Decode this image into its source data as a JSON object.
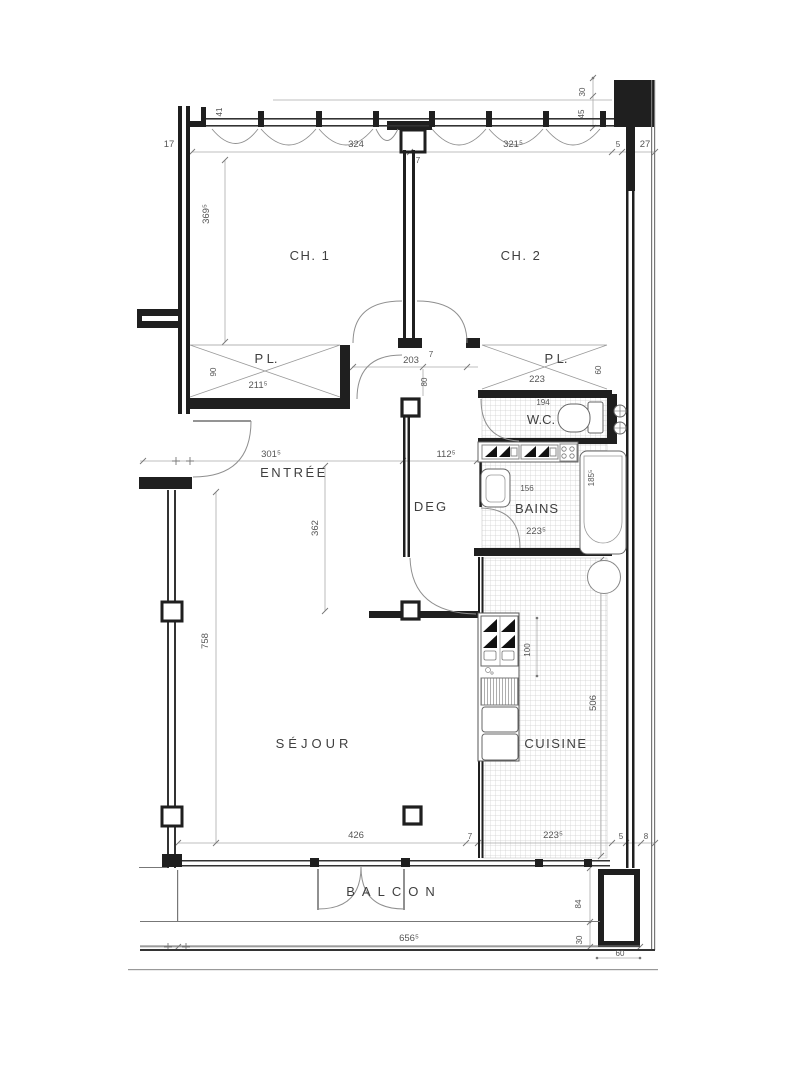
{
  "page": {
    "type": "apartment floor plan drawing",
    "background": "#ffffff"
  },
  "colors": {
    "wall": "#1f1f1f",
    "thin_line": "#777777",
    "dim_line": "#ababab",
    "dim_text": "#555555",
    "room_text": "#3f3f3f",
    "tile": "#cfcfcf",
    "fixture": "#666666"
  },
  "labels": {
    "ch1": "CH. 1",
    "ch2": "CH. 2",
    "pl_left": "P L.",
    "pl_right": "P L.",
    "wc": "W.C.",
    "bains": "BAINS",
    "entree": "ENTRÉE",
    "deg": "DEG",
    "sejour": "SÉJOUR",
    "cuisine": "CUISINE",
    "balcon": "BALCON"
  },
  "dimensions": {
    "top_window_left": "324",
    "top_window_right": "321⁵",
    "top_mullion": "7",
    "wall_17": "17",
    "sill_41": "41",
    "col_30": "30",
    "col_45": "45",
    "col_5": "5",
    "col_27": "27",
    "ch1_depth": "369⁵",
    "pl_left_width": "211⁵",
    "pl_left_depth": "90",
    "corridor_width": "203",
    "corridor_wall": "7",
    "corridor_gap": "80",
    "pl_right_width": "223",
    "pl_right_depth": "60",
    "wc_width": "194",
    "entree_width": "301⁵",
    "deg_width": "112⁵",
    "deg_length": "362",
    "bains_front": "156",
    "bains_width": "223⁵",
    "tub_length": "185⁵",
    "sejour_depth": "758",
    "sejour_width": "426",
    "counter_length": "100",
    "cuisine_depth": "506",
    "cuisine_width": "223⁵",
    "wall_7": "7",
    "wall_5": "5",
    "wall_8": "8",
    "balcon_length": "656⁵",
    "balcon_depth": "84",
    "balcon_slab": "30",
    "balcon_edge": "60"
  }
}
